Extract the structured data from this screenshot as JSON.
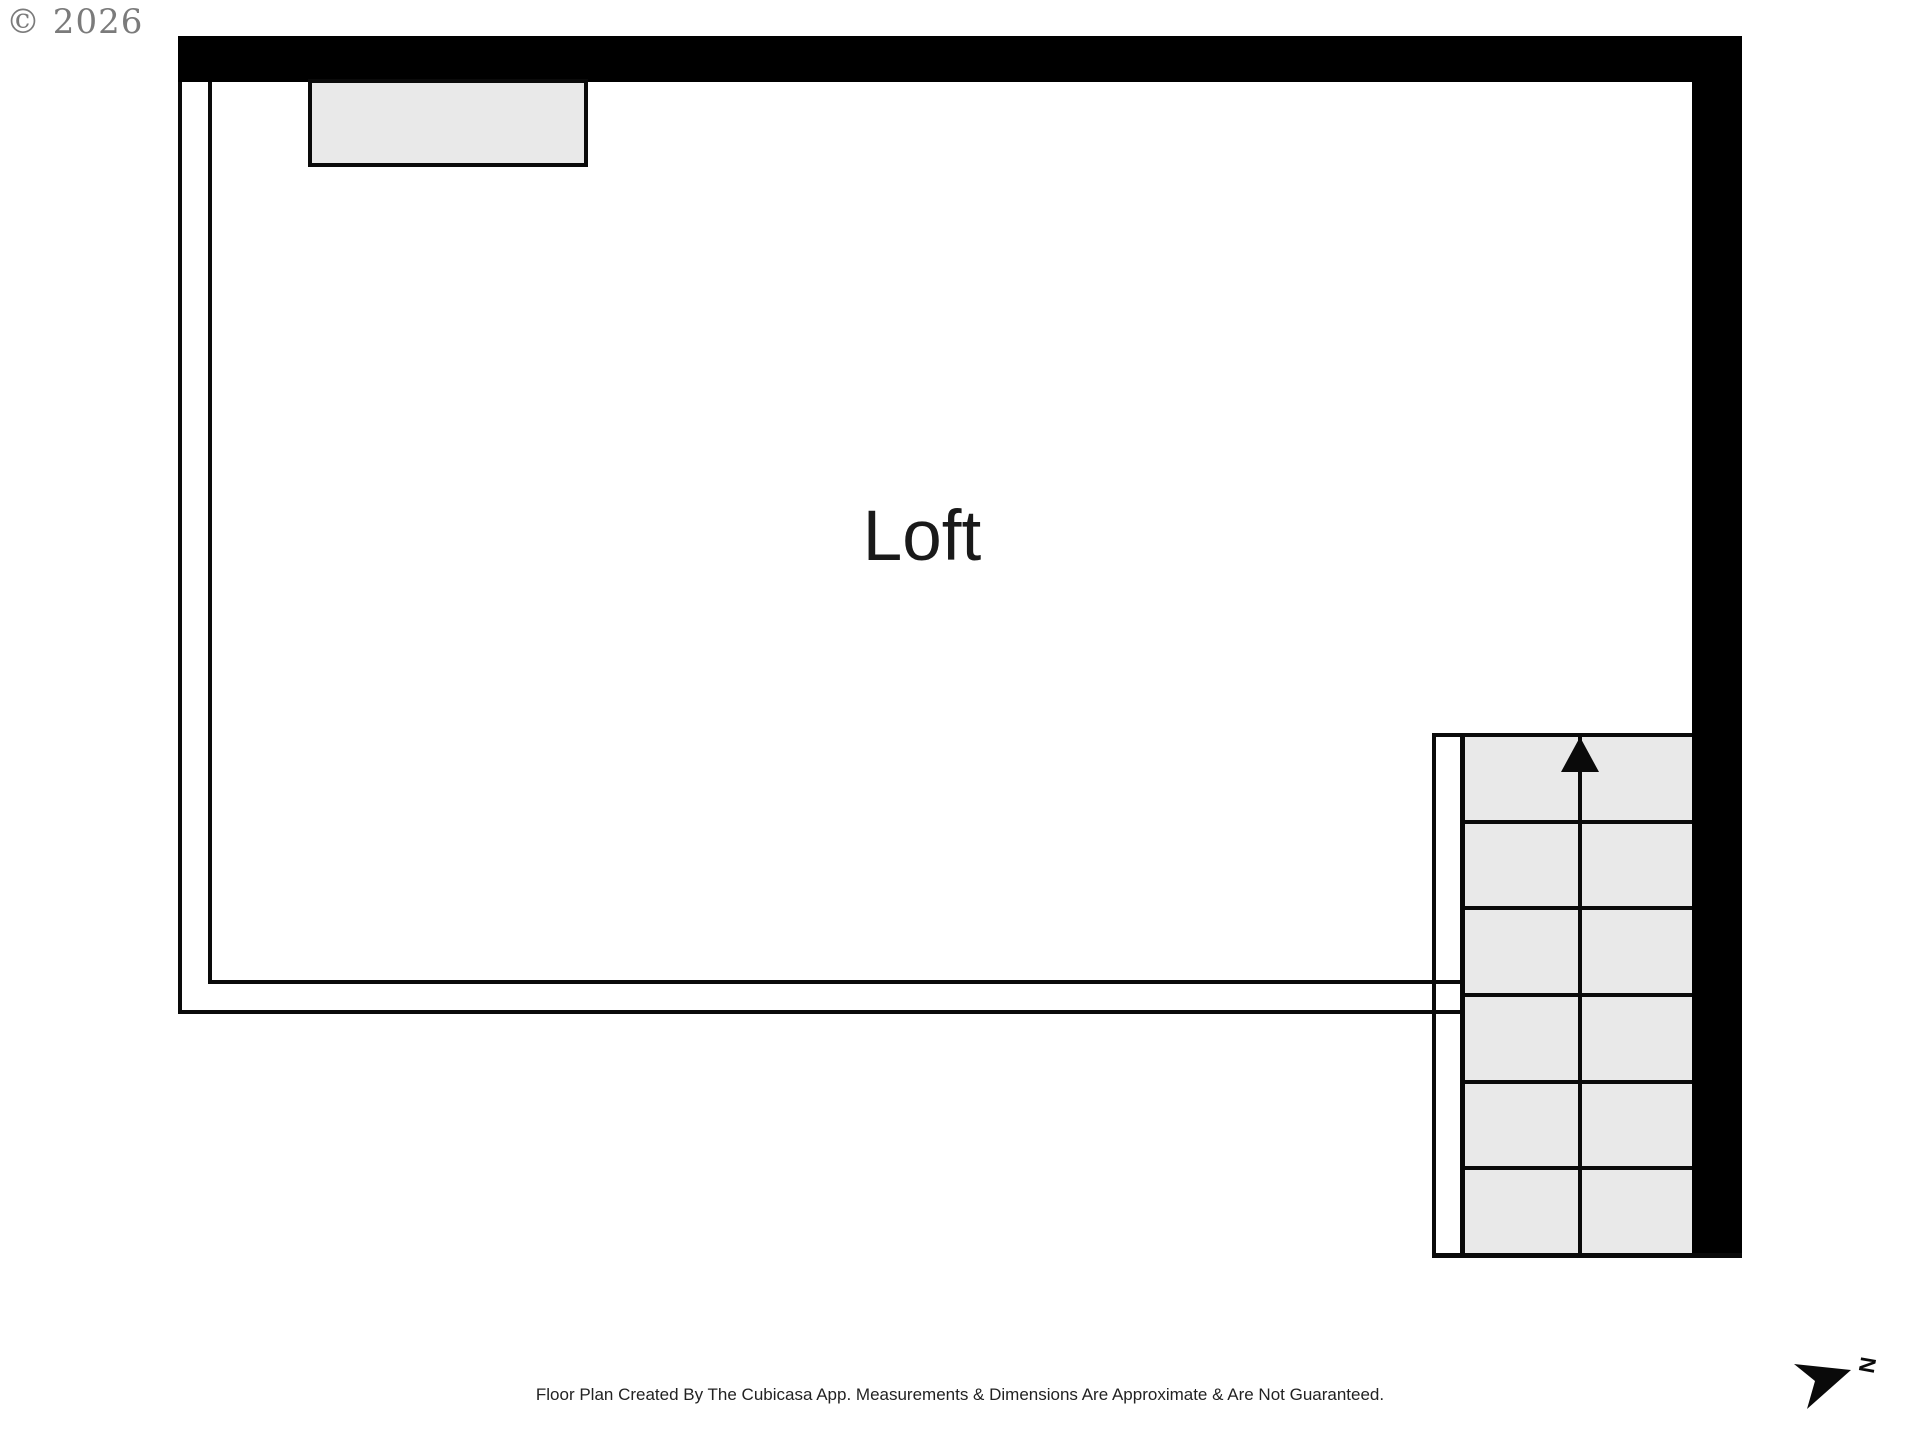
{
  "page": {
    "copyright": "© 2026",
    "disclaimer": "Floor Plan Created By The Cubicasa App. Measurements & Dimensions Are Approximate & Are Not Guaranteed."
  },
  "floor_plan": {
    "room_label": "Loft",
    "stairs": {
      "visible_steps": 6,
      "direction": "up"
    },
    "compass": {
      "label": "N"
    },
    "colors": {
      "wall": "#000000",
      "line": "#0a0a0a",
      "furniture_fill": "#e9e9e9",
      "room_fill": "#ffffff",
      "label_color": "#1a1a1a",
      "copyright_color": "#7b7b7b",
      "disclaimer_color": "#222222"
    }
  }
}
